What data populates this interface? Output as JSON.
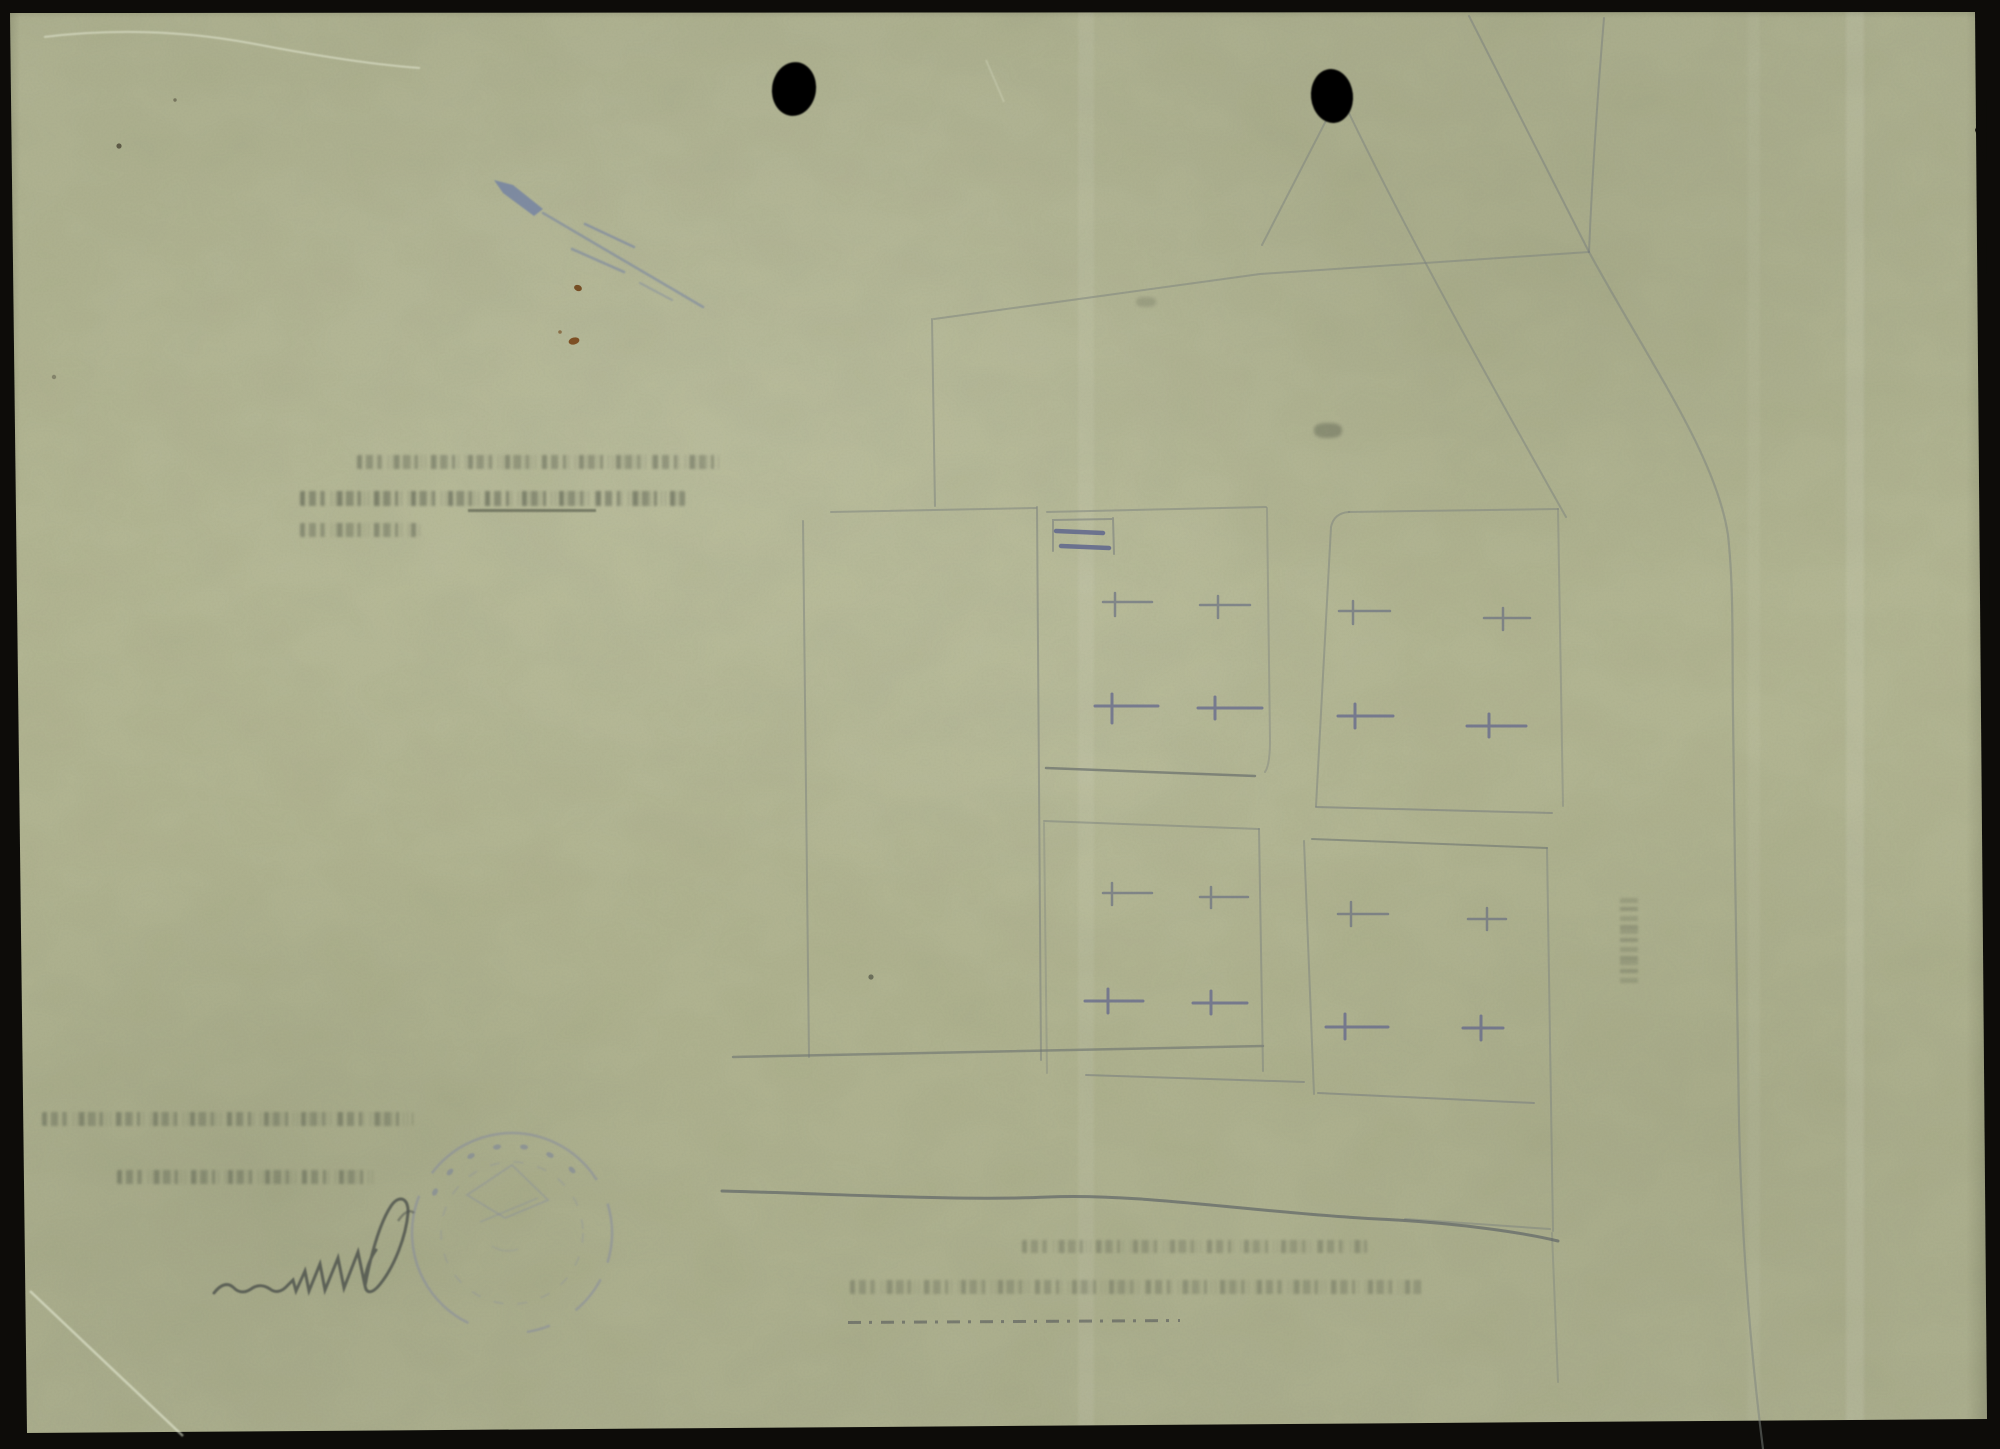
{
  "document": {
    "description": "Scanned verso of an old archival paper sheet; no machine-readable text visible",
    "visible_text": "",
    "punch_hole_count": 2,
    "pencil_sketch": {
      "kind": "faint site plan: one large building outline, four plot rectangles each with four cross marks, boundary and road lines",
      "plots": 4,
      "crosses_per_plot": 4
    },
    "bleedthrough_text": {
      "legible": false,
      "note_upper_left_lines": 3,
      "note_lower_left_lines": 2,
      "note_bottom_center_lines": 2
    },
    "stamp": {
      "shape": "round",
      "legible": false
    },
    "signature": {
      "medium": "graphite pencil",
      "legible": false
    },
    "colors": {
      "scanner_background": "#0d0c09",
      "paper": "#b5b897",
      "pencil_line": "#7b817e",
      "violet_pencil": "#5d618b",
      "blue_crayon": "#6d7ca4",
      "stamp_ink": "#7d84a3",
      "signature_graphite": "#4b504b",
      "rust_spot": "#74451b",
      "punch_hole": "#050505"
    },
    "labels": {
      "paper": "scanned paper sheet",
      "holes": "two black punch holes",
      "plan": "faint pencil site-plan sketch",
      "stamp": "faint round ink stamp",
      "signature": "handwritten pencil signature",
      "bleed": "illegible mirrored typewritten show-through"
    }
  }
}
